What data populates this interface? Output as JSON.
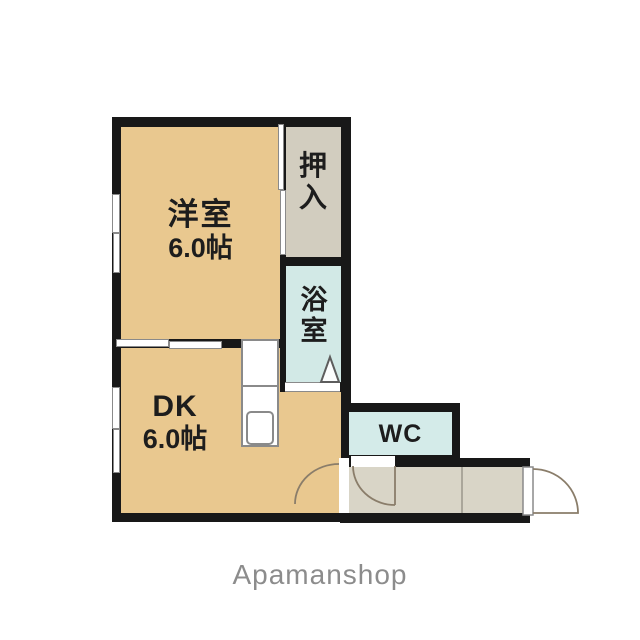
{
  "watermark": "Apamanshop",
  "rooms": {
    "western": {
      "name": "洋室",
      "size": "6.0帖"
    },
    "closet": {
      "name": "押入"
    },
    "bath": {
      "name": "浴室"
    },
    "dk": {
      "name": "DK",
      "size": "6.0帖"
    },
    "wc": {
      "name": "WC"
    }
  },
  "colors": {
    "background": "#ffffff",
    "wall": "#181818",
    "room-fill": "#e9c88f",
    "closet-fill": "#d2cdbf",
    "bath-fill": "#d2e9e6",
    "wc-fill": "#d4ebe9",
    "hall-fill": "#d9d5c7",
    "fixture-outline": "#8a8a8a",
    "door-stroke": "#8a7d6a",
    "label": "#1d1d1d",
    "watermark": "#8c8c8c"
  }
}
